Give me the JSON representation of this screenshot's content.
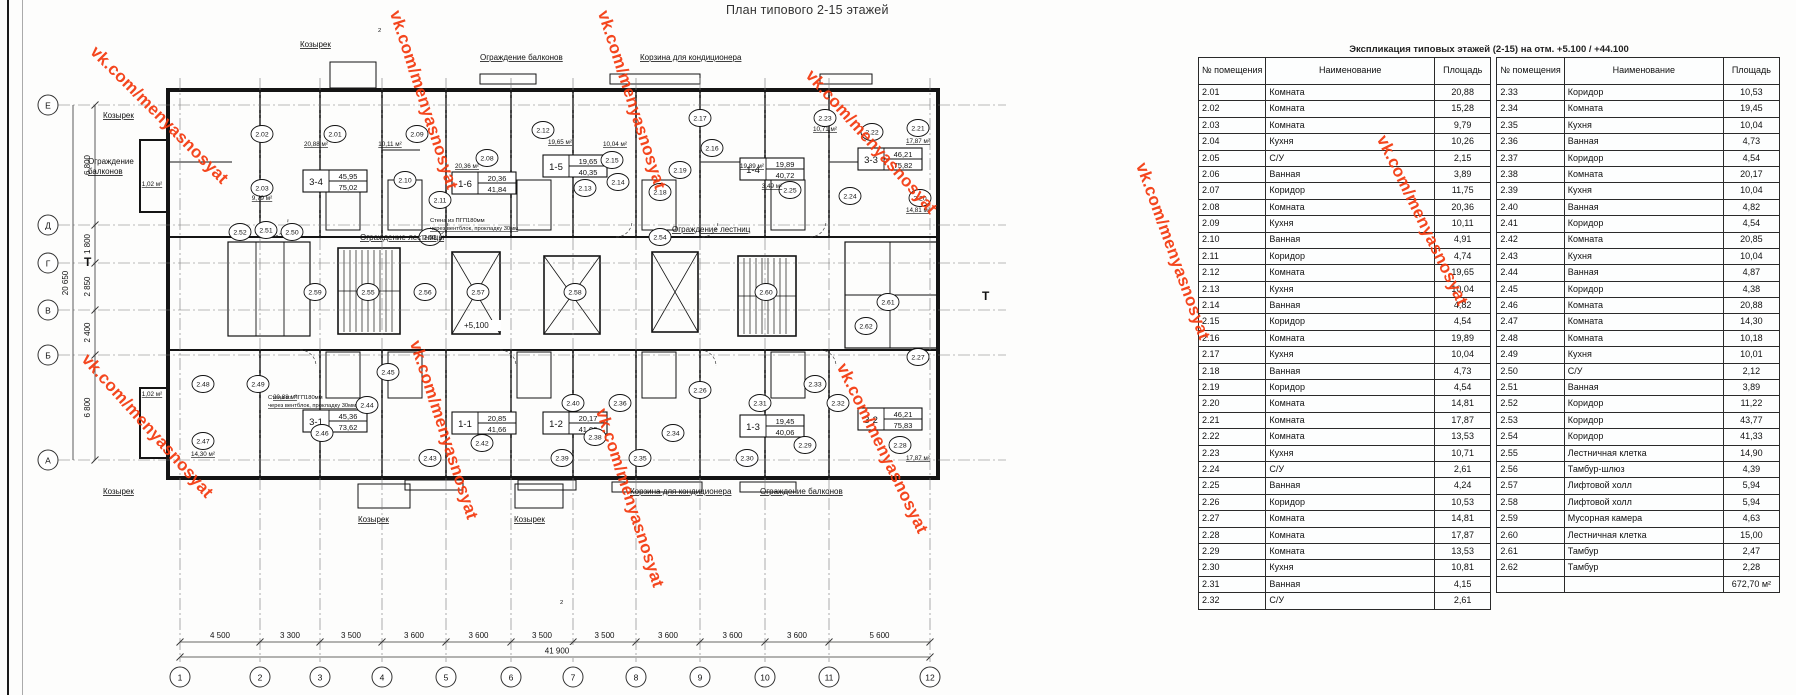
{
  "title": "План типового 2-15 этажей",
  "watermark": {
    "text": "vk.com/menyasnosyat",
    "color": "#f4390e",
    "positions": [
      {
        "x": 100,
        "y": 42,
        "r": 45
      },
      {
        "x": 404,
        "y": 8,
        "r": 72
      },
      {
        "x": 612,
        "y": 8,
        "r": 72
      },
      {
        "x": 816,
        "y": 66,
        "r": 48
      },
      {
        "x": 92,
        "y": 350,
        "r": 48
      },
      {
        "x": 424,
        "y": 338,
        "r": 72
      },
      {
        "x": 610,
        "y": 406,
        "r": 72
      },
      {
        "x": 850,
        "y": 360,
        "r": 64
      },
      {
        "x": 1150,
        "y": 160,
        "r": 70
      },
      {
        "x": 1390,
        "y": 132,
        "r": 64
      }
    ]
  },
  "table": {
    "title": "Экспликация типовых этажей (2-15) на отм. +5.100 / +44.100",
    "headers": [
      "№ помещения",
      "Наименование",
      "Площадь"
    ],
    "left_rows": [
      [
        "2.01",
        "Комната",
        "20,88"
      ],
      [
        "2.02",
        "Комната",
        "15,28"
      ],
      [
        "2.03",
        "Комната",
        "9,79"
      ],
      [
        "2.04",
        "Кухня",
        "10,26"
      ],
      [
        "2.05",
        "С/У",
        "2,15"
      ],
      [
        "2.06",
        "Ванная",
        "3,89"
      ],
      [
        "2.07",
        "Коридор",
        "11,75"
      ],
      [
        "2.08",
        "Комната",
        "20,36"
      ],
      [
        "2.09",
        "Кухня",
        "10,11"
      ],
      [
        "2.10",
        "Ванная",
        "4,91"
      ],
      [
        "2.11",
        "Коридор",
        "4,74"
      ],
      [
        "2.12",
        "Комната",
        "19,65"
      ],
      [
        "2.13",
        "Кухня",
        "10,04"
      ],
      [
        "2.14",
        "Ванная",
        "4,82"
      ],
      [
        "2.15",
        "Коридор",
        "4,54"
      ],
      [
        "2.16",
        "Комната",
        "19,89"
      ],
      [
        "2.17",
        "Кухня",
        "10,04"
      ],
      [
        "2.18",
        "Ванная",
        "4,73"
      ],
      [
        "2.19",
        "Коридор",
        "4,54"
      ],
      [
        "2.20",
        "Комната",
        "14,81"
      ],
      [
        "2.21",
        "Комната",
        "17,87"
      ],
      [
        "2.22",
        "Комната",
        "13,53"
      ],
      [
        "2.23",
        "Кухня",
        "10,71"
      ],
      [
        "2.24",
        "С/У",
        "2,61"
      ],
      [
        "2.25",
        "Ванная",
        "4,24"
      ],
      [
        "2.26",
        "Коридор",
        "10,53"
      ],
      [
        "2.27",
        "Комната",
        "14,81"
      ],
      [
        "2.28",
        "Комната",
        "17,87"
      ],
      [
        "2.29",
        "Комната",
        "13,53"
      ],
      [
        "2.30",
        "Кухня",
        "10,81"
      ],
      [
        "2.31",
        "Ванная",
        "4,15"
      ],
      [
        "2.32",
        "С/У",
        "2,61"
      ]
    ],
    "right_rows": [
      [
        "2.33",
        "Коридор",
        "10,53"
      ],
      [
        "2.34",
        "Комната",
        "19,45"
      ],
      [
        "2.35",
        "Кухня",
        "10,04"
      ],
      [
        "2.36",
        "Ванная",
        "4,73"
      ],
      [
        "2.37",
        "Коридор",
        "4,54"
      ],
      [
        "2.38",
        "Комната",
        "20,17"
      ],
      [
        "2.39",
        "Кухня",
        "10,04"
      ],
      [
        "2.40",
        "Ванная",
        "4,82"
      ],
      [
        "2.41",
        "Коридор",
        "4,54"
      ],
      [
        "2.42",
        "Комната",
        "20,85"
      ],
      [
        "2.43",
        "Кухня",
        "10,04"
      ],
      [
        "2.44",
        "Ванная",
        "4,87"
      ],
      [
        "2.45",
        "Коридор",
        "4,38"
      ],
      [
        "2.46",
        "Комната",
        "20,88"
      ],
      [
        "2.47",
        "Комната",
        "14,30"
      ],
      [
        "2.48",
        "Комната",
        "10,18"
      ],
      [
        "2.49",
        "Кухня",
        "10,01"
      ],
      [
        "2.50",
        "С/У",
        "2,12"
      ],
      [
        "2.51",
        "Ванная",
        "3,89"
      ],
      [
        "2.52",
        "Коридор",
        "11,22"
      ],
      [
        "2.53",
        "Коридор",
        "43,77"
      ],
      [
        "2.54",
        "Коридор",
        "41,33"
      ],
      [
        "2.55",
        "Лестничная клетка",
        "14,90"
      ],
      [
        "2.56",
        "Тамбур-шлюз",
        "4,39"
      ],
      [
        "2.57",
        "Лифтовой холл",
        "5,94"
      ],
      [
        "2.58",
        "Лифтовой холл",
        "5,94"
      ],
      [
        "2.59",
        "Мусорная камера",
        "4,63"
      ],
      [
        "2.60",
        "Лестничная клетка",
        "15,00"
      ],
      [
        "2.61",
        "Тамбур",
        "2,47"
      ],
      [
        "2.62",
        "Тамбур",
        "2,28"
      ]
    ],
    "total": "672,70 м²"
  },
  "plan": {
    "axes_bottom": {
      "labels": [
        "1",
        "2",
        "3",
        "4",
        "5",
        "6",
        "7",
        "8",
        "9",
        "10",
        "11",
        "12"
      ],
      "x": [
        180,
        260,
        320,
        382,
        446,
        511,
        573,
        636,
        700,
        765,
        829,
        930
      ]
    },
    "axes_left": {
      "labels": [
        "Е",
        "Д",
        "Г",
        "В",
        "Б",
        "А"
      ],
      "y": [
        105,
        225,
        263,
        310,
        355,
        460
      ]
    },
    "dims_bottom": {
      "segments": [
        "4 500",
        "3 300",
        "3 500",
        "3 600",
        "3 600",
        "3 500",
        "3 500",
        "3 600",
        "3 600",
        "3 600",
        "5 600"
      ],
      "total": "41 900"
    },
    "dims_left": {
      "segments": [
        "6 800",
        "1 800",
        "2 850",
        "2 400",
        "6 800"
      ],
      "total": "20 650"
    },
    "apartments": [
      {
        "code": "3-4",
        "upper": "45,95",
        "lower": "75,02",
        "x": 303,
        "y": 170
      },
      {
        "code": "1-6",
        "upper": "20,36",
        "lower": "41,84",
        "x": 452,
        "y": 172
      },
      {
        "code": "1-5",
        "upper": "19,65",
        "lower": "40,35",
        "x": 543,
        "y": 155
      },
      {
        "code": "1-4",
        "upper": "19,89",
        "lower": "40,72",
        "x": 740,
        "y": 158
      },
      {
        "code": "3-3",
        "upper": "46,21",
        "lower": "75,82",
        "x": 858,
        "y": 148
      },
      {
        "code": "3-1",
        "upper": "45,36",
        "lower": "73,62",
        "x": 303,
        "y": 410
      },
      {
        "code": "1-1",
        "upper": "20,85",
        "lower": "41,66",
        "x": 452,
        "y": 412
      },
      {
        "code": "1-2",
        "upper": "20,17",
        "lower": "41,09",
        "x": 543,
        "y": 412
      },
      {
        "code": "1-3",
        "upper": "19,45",
        "lower": "40,06",
        "x": 740,
        "y": 415
      },
      {
        "code": "3-2",
        "upper": "46,21",
        "lower": "75,83",
        "x": 858,
        "y": 408
      }
    ],
    "room_circles": [
      {
        "n": "2.02",
        "x": 262,
        "y": 134
      },
      {
        "n": "2.01",
        "x": 335,
        "y": 134
      },
      {
        "n": "2.09",
        "x": 417,
        "y": 134
      },
      {
        "n": "2.08",
        "x": 487,
        "y": 158
      },
      {
        "n": "2.12",
        "x": 543,
        "y": 130
      },
      {
        "n": "2.15",
        "x": 612,
        "y": 160
      },
      {
        "n": "2.14",
        "x": 618,
        "y": 182
      },
      {
        "n": "2.13",
        "x": 585,
        "y": 188
      },
      {
        "n": "2.17",
        "x": 700,
        "y": 118
      },
      {
        "n": "2.16",
        "x": 712,
        "y": 148
      },
      {
        "n": "2.23",
        "x": 825,
        "y": 118
      },
      {
        "n": "2.22",
        "x": 872,
        "y": 132
      },
      {
        "n": "2.21",
        "x": 918,
        "y": 128
      },
      {
        "n": "2.20",
        "x": 920,
        "y": 198
      },
      {
        "n": "2.03",
        "x": 262,
        "y": 188
      },
      {
        "n": "2.11",
        "x": 440,
        "y": 200
      },
      {
        "n": "2.10",
        "x": 405,
        "y": 180
      },
      {
        "n": "2.18",
        "x": 660,
        "y": 192
      },
      {
        "n": "2.19",
        "x": 680,
        "y": 170
      },
      {
        "n": "2.24",
        "x": 850,
        "y": 196
      },
      {
        "n": "2.25",
        "x": 790,
        "y": 190
      },
      {
        "n": "2.52",
        "x": 240,
        "y": 232
      },
      {
        "n": "2.51",
        "x": 266,
        "y": 230
      },
      {
        "n": "2.50",
        "x": 292,
        "y": 232
      },
      {
        "n": "2.53",
        "x": 430,
        "y": 237
      },
      {
        "n": "2.54",
        "x": 660,
        "y": 237
      },
      {
        "n": "2.59",
        "x": 315,
        "y": 292
      },
      {
        "n": "2.55",
        "x": 368,
        "y": 292
      },
      {
        "n": "2.56",
        "x": 425,
        "y": 292
      },
      {
        "n": "2.57",
        "x": 478,
        "y": 292
      },
      {
        "n": "2.58",
        "x": 575,
        "y": 292
      },
      {
        "n": "2.60",
        "x": 766,
        "y": 292
      },
      {
        "n": "2.61",
        "x": 888,
        "y": 302
      },
      {
        "n": "2.62",
        "x": 866,
        "y": 326
      },
      {
        "n": "2.48",
        "x": 203,
        "y": 384
      },
      {
        "n": "2.47",
        "x": 203,
        "y": 441
      },
      {
        "n": "2.49",
        "x": 258,
        "y": 384
      },
      {
        "n": "2.46",
        "x": 322,
        "y": 433
      },
      {
        "n": "2.44",
        "x": 367,
        "y": 405
      },
      {
        "n": "2.45",
        "x": 388,
        "y": 372
      },
      {
        "n": "2.42",
        "x": 482,
        "y": 443
      },
      {
        "n": "2.43",
        "x": 430,
        "y": 458
      },
      {
        "n": "2.40",
        "x": 573,
        "y": 403
      },
      {
        "n": "2.36",
        "x": 620,
        "y": 403
      },
      {
        "n": "2.38",
        "x": 595,
        "y": 437
      },
      {
        "n": "2.39",
        "x": 562,
        "y": 458
      },
      {
        "n": "2.34",
        "x": 673,
        "y": 433
      },
      {
        "n": "2.35",
        "x": 640,
        "y": 458
      },
      {
        "n": "2.31",
        "x": 760,
        "y": 403
      },
      {
        "n": "2.30",
        "x": 747,
        "y": 458
      },
      {
        "n": "2.29",
        "x": 805,
        "y": 445
      },
      {
        "n": "2.28",
        "x": 900,
        "y": 445
      },
      {
        "n": "2.27",
        "x": 918,
        "y": 357
      },
      {
        "n": "2.32",
        "x": 838,
        "y": 403
      },
      {
        "n": "2.33",
        "x": 815,
        "y": 384
      },
      {
        "n": "2.26",
        "x": 700,
        "y": 390
      }
    ],
    "area_labels": [
      {
        "t": "20,88 м²",
        "x": 316,
        "y": 146
      },
      {
        "t": "10,11 м²",
        "x": 390,
        "y": 146
      },
      {
        "t": "9,79 м²",
        "x": 262,
        "y": 200
      },
      {
        "t": "20,36 м²",
        "x": 467,
        "y": 168
      },
      {
        "t": "19,65 м²",
        "x": 560,
        "y": 144
      },
      {
        "t": "10,04 м²",
        "x": 615,
        "y": 146
      },
      {
        "t": "19,89 м²",
        "x": 752,
        "y": 168
      },
      {
        "t": "10,71 м²",
        "x": 825,
        "y": 131
      },
      {
        "t": "17,87 м²",
        "x": 918,
        "y": 143
      },
      {
        "t": "14,81 м²",
        "x": 918,
        "y": 212
      },
      {
        "t": "1,02 м²",
        "x": 152,
        "y": 186
      },
      {
        "t": "1,02 м²",
        "x": 152,
        "y": 396
      },
      {
        "t": "14,30 м²",
        "x": 203,
        "y": 456
      },
      {
        "t": "17,87 м²",
        "x": 918,
        "y": 460
      },
      {
        "t": "20,88 м²",
        "x": 285,
        "y": 399
      },
      {
        "t": "3,49 м²",
        "x": 772,
        "y": 188
      }
    ],
    "annotations": [
      {
        "t": "Козырек",
        "x": 300,
        "y": 47,
        "u": 1
      },
      {
        "t": "Ограждение балконов",
        "x": 480,
        "y": 60,
        "u": 1
      },
      {
        "t": "Корзина для кондиционера",
        "x": 640,
        "y": 60,
        "u": 1
      },
      {
        "t": "Козырек",
        "x": 103,
        "y": 118,
        "u": 1
      },
      {
        "t": "Ограждение",
        "x": 88,
        "y": 164,
        "u": 0
      },
      {
        "t": "балконов",
        "x": 88,
        "y": 174,
        "u": 1
      },
      {
        "t": "Ограждение лестницы",
        "x": 360,
        "y": 240,
        "u": 1
      },
      {
        "t": "Ограждение лестниц",
        "x": 672,
        "y": 232,
        "u": 1
      },
      {
        "t": "Стена из ПГП180мм",
        "x": 268,
        "y": 399,
        "u": 0,
        "s": 1
      },
      {
        "t": "через вентблок, прокладку 30мм",
        "x": 268,
        "y": 407,
        "u": 1,
        "s": 1
      },
      {
        "t": "Стена из ПГП180мм",
        "x": 430,
        "y": 222,
        "u": 0,
        "s": 1
      },
      {
        "t": "через вентблок, прокладку 30мм",
        "x": 430,
        "y": 230,
        "u": 1,
        "s": 1
      },
      {
        "t": "+5,100",
        "x": 464,
        "y": 328,
        "u": 0,
        "bg": 1
      },
      {
        "t": "Козырек",
        "x": 103,
        "y": 494,
        "u": 1
      },
      {
        "t": "Козырек",
        "x": 358,
        "y": 522,
        "u": 1
      },
      {
        "t": "Козырек",
        "x": 514,
        "y": 522,
        "u": 1
      },
      {
        "t": "Корзина для кондиционера",
        "x": 630,
        "y": 494,
        "u": 1
      },
      {
        "t": "Ограждение балконов",
        "x": 760,
        "y": 494,
        "u": 1
      },
      {
        "t": "Т",
        "x": 84,
        "y": 266,
        "b": 1
      },
      {
        "t": "Т",
        "x": 982,
        "y": 300,
        "b": 1
      },
      {
        "t": "2",
        "x": 378,
        "y": 32,
        "s": 1
      },
      {
        "t": "2",
        "x": 560,
        "y": 604,
        "s": 1
      }
    ]
  }
}
